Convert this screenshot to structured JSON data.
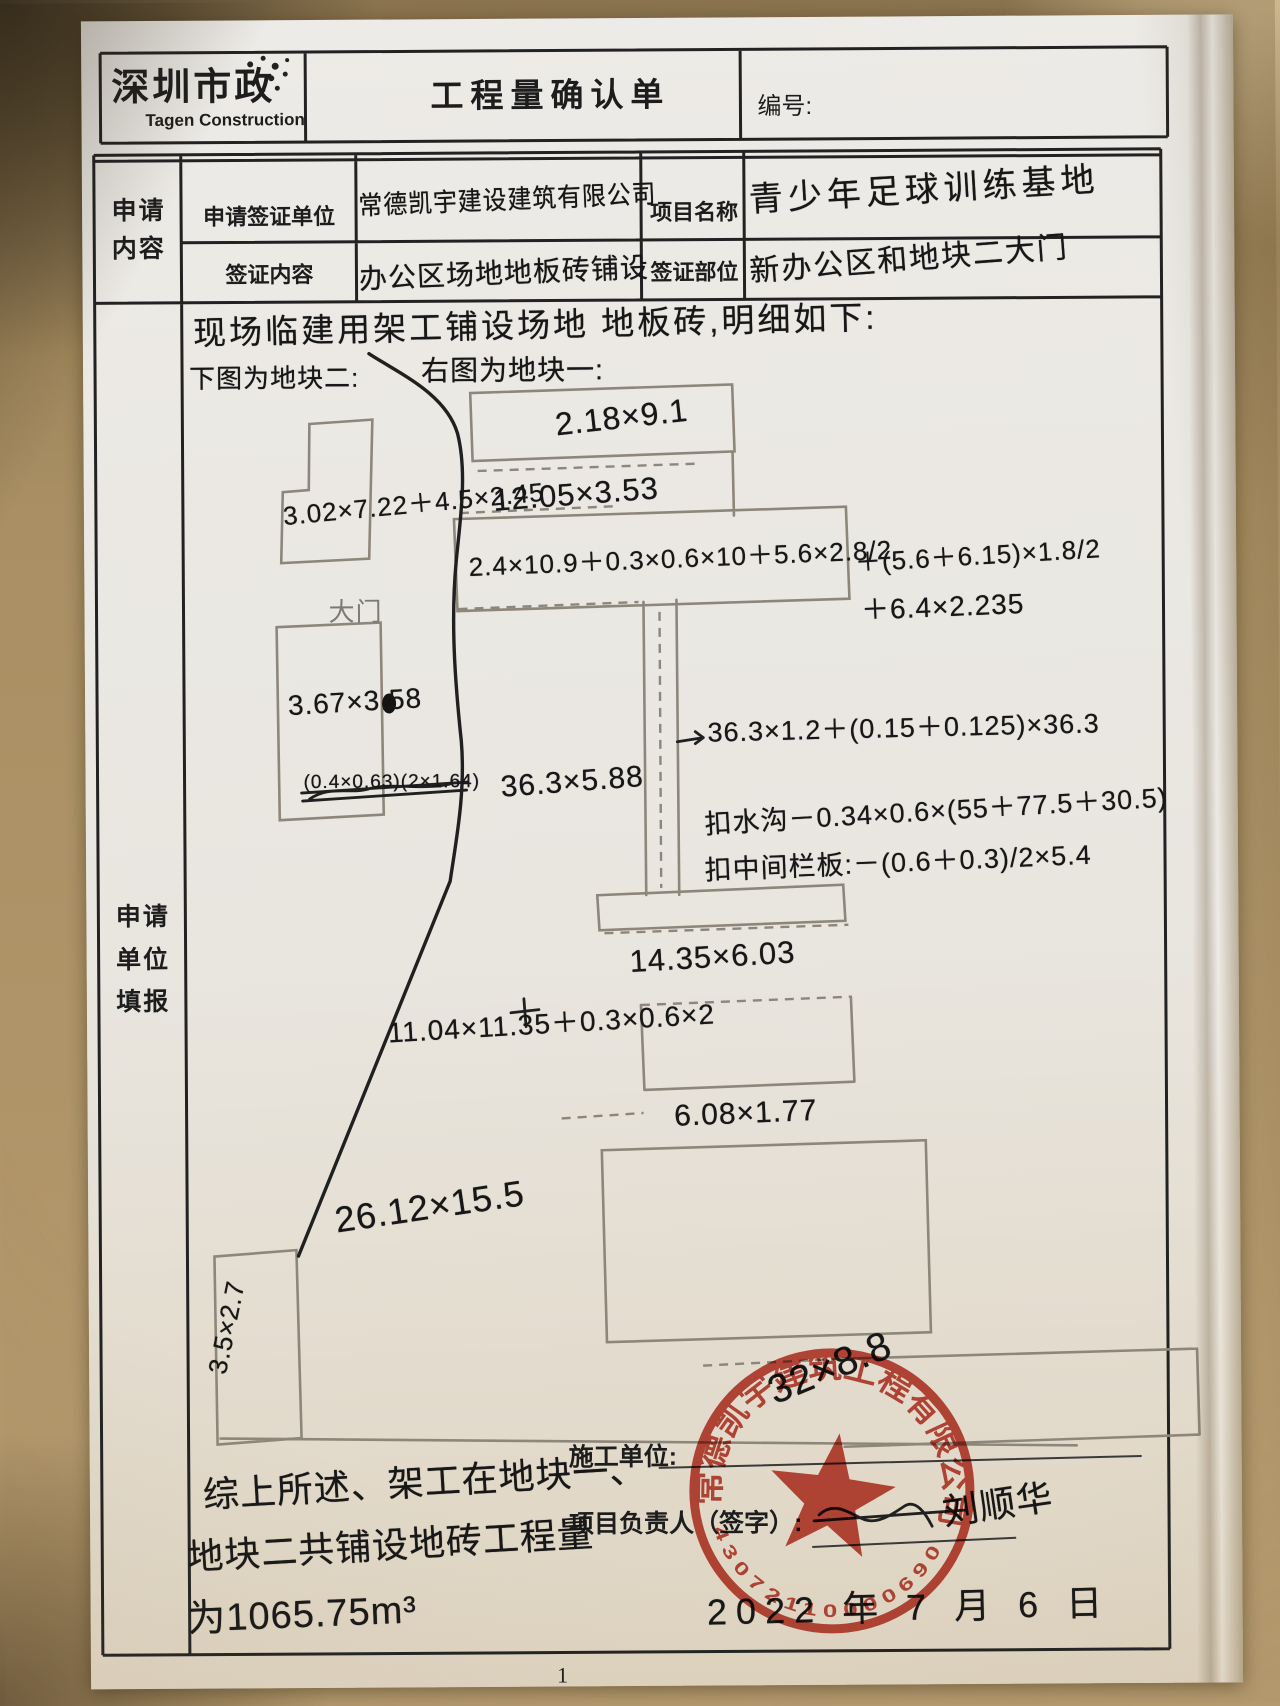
{
  "header": {
    "logo_cn": "深圳市政",
    "logo_en": "Tagen Construction",
    "title": "工程量确认单",
    "number_label": "编号:"
  },
  "form": {
    "left_label_top": "申请\n内容",
    "left_label_main": "申请\n单位\n填报",
    "field1_label": "申请签证单位",
    "field1_value": "常德凯宇建设建筑有限公司",
    "field2_label": "项目名称",
    "field2_value": "青少年足球训练基地",
    "field3_label": "签证内容",
    "field3_value": "办公区场地地板砖铺设",
    "field4_label": "签证部位",
    "field4_value": "新办公区和地块二大门"
  },
  "sketch": {
    "intro1": "现场临建用架工铺设场地 地板砖,明细如下:",
    "intro2a": "下图为地块二:",
    "intro2b": "右图为地块一:",
    "gate": "大门",
    "d_top": "2.18×9.1",
    "d_1205": "12.05×3.53",
    "d_302": "3.02×7.22＋4.5×2.45",
    "d_24": "2.4×10.9＋0.3×0.6×10＋5.6×2.8/2",
    "d_56": "＋(5.6＋6.15)×1.8/2",
    "d_64": "＋6.4×2.235",
    "d_367": "3.67×3.58",
    "d_struck": "(0.4×0.63)(2×1.64)",
    "d_363588": "36.3×5.88",
    "d_arrow": "36.3×1.2＋(0.15＋0.125)×36.3",
    "d_gutter": "扣水沟－0.34×0.6×(55＋77.5＋30.5)",
    "d_mid": "扣中间栏板:－(0.6＋0.3)/2×5.4",
    "d_1435": "14.35×6.03",
    "d_1104": "11.04×11.35＋0.3×0.6×2",
    "d_608": "6.08×1.77",
    "d_2612": "26.12×15.5",
    "d_35": "3.5×2.7",
    "stamp_overwrite": "32×8.8"
  },
  "footer": {
    "summary1": "综上所述、架工在地块一、",
    "summary2": "地块二共铺设地砖工程量",
    "summary3": "为1065.75m³",
    "contractor_label": "施工单位:",
    "manager_label": "项目负责人（签字）:",
    "signature": "刘顺华",
    "date": "2022 年 7 月 6 日",
    "page_number": "1"
  },
  "stamp": {
    "company": "常德凯宇建筑工程有限公司",
    "number": "43072110000690",
    "color": "#bf3a2c"
  }
}
